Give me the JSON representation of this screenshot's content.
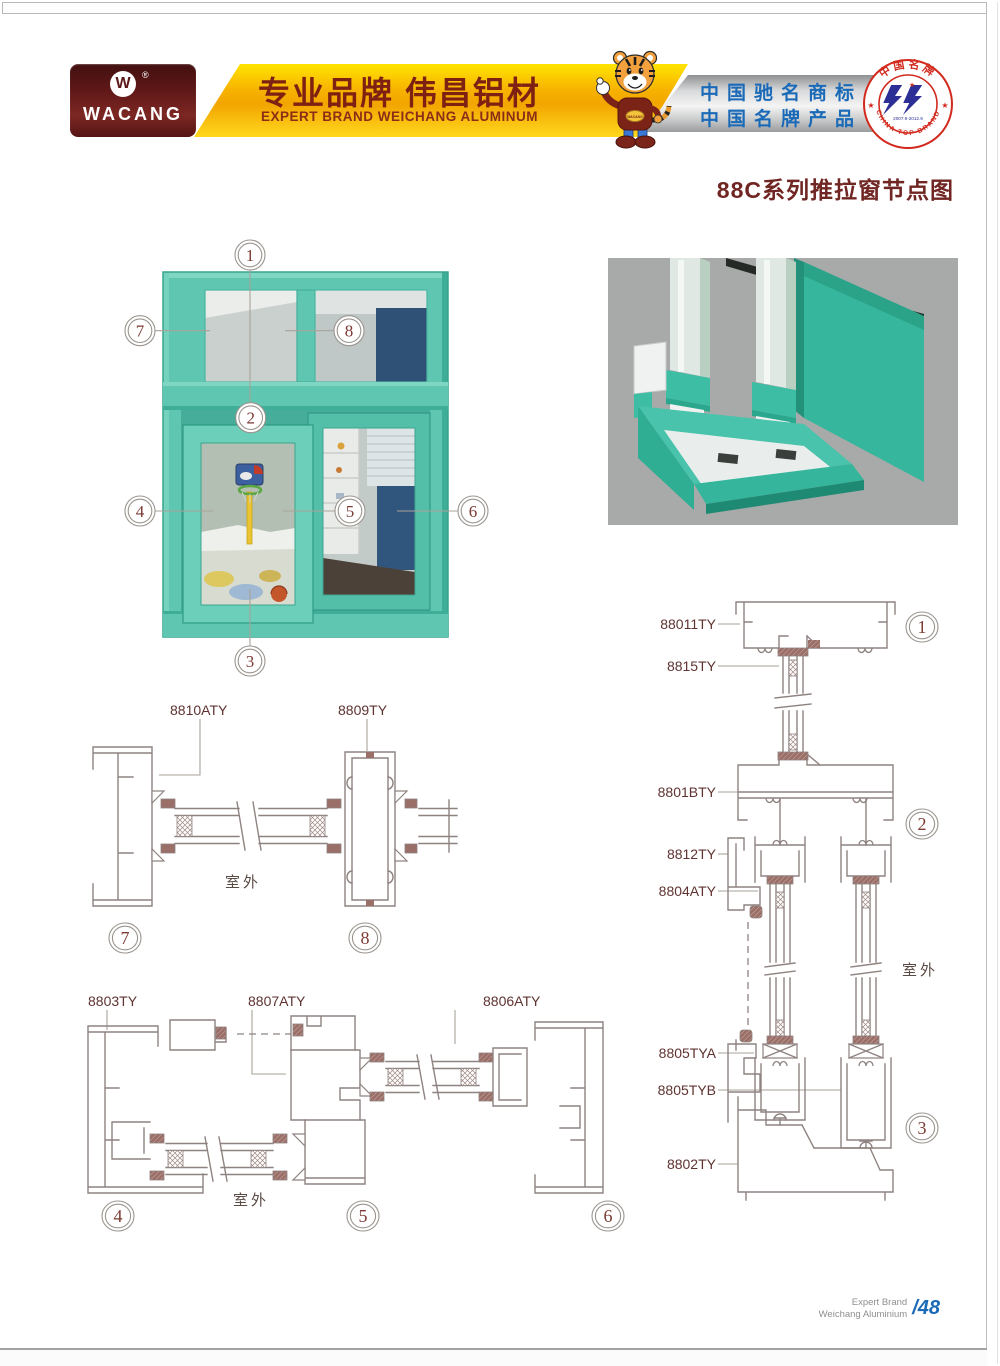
{
  "header": {
    "logo": {
      "mark": "W",
      "registered": "®",
      "name": "WACANG"
    },
    "slogan_cn": "专业品牌  伟昌铝材",
    "slogan_en": "EXPERT BRAND WEICHANG ALUMINUM",
    "honors": {
      "line1": "中国驰名商标",
      "line2": "中国名牌产品"
    },
    "badge": {
      "top": "中国名牌",
      "bottom": "CHINA TOP BRAND",
      "years": "2007.9-2012.9",
      "star": "★"
    },
    "mascot": "tiger-mascot"
  },
  "title": "88C系列推拉窗节点图",
  "window": {
    "callouts": [
      "1",
      "2",
      "3",
      "4",
      "5",
      "6",
      "7",
      "8"
    ]
  },
  "drawings": {
    "outdoor": "室外",
    "top": {
      "labels": [
        "8810ATY",
        "8809TY"
      ],
      "callouts": [
        "7",
        "8"
      ]
    },
    "bottom": {
      "labels": [
        "8803TY",
        "8807ATY",
        "8806ATY"
      ],
      "callouts": [
        "4",
        "5",
        "6"
      ]
    },
    "right": {
      "labels": [
        "88011TY",
        "8815TY",
        "8801BTY",
        "8812TY",
        "8804ATY",
        "8805TYA",
        "8805TYB",
        "8802TY"
      ],
      "callouts": [
        "1",
        "2",
        "3"
      ]
    }
  },
  "footer": {
    "line1": "Expert Brand",
    "line2": "Weichang Aluminium",
    "page": "/48"
  },
  "colors": {
    "teal": "#5ec6b1",
    "maroon": "#6c1f1f",
    "gold": "#f2a500",
    "yellow": "#ffe400",
    "blue": "#1a6ab8",
    "badge_red": "#d22a1e",
    "line": "#8e8380",
    "label": "#5e3330",
    "title": "#702622"
  }
}
